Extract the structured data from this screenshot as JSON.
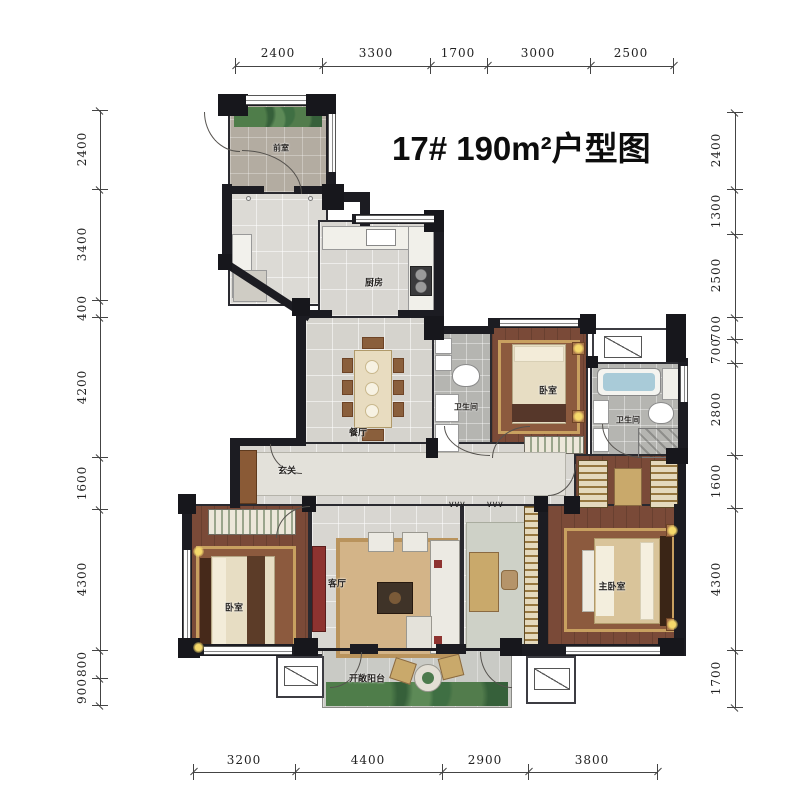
{
  "title": "17# 190m²户型图",
  "plan": {
    "rooms": {
      "vestibule": "前室",
      "kitchen": "厨房",
      "dining": "餐厅",
      "bath1": "卫生间",
      "bedroom2": "卧室",
      "bath2": "卫生间",
      "foyer": "玄关",
      "living": "客厅",
      "bedroom3": "卧室",
      "master_bedroom": "主卧室",
      "balcony": "开敞阳台"
    },
    "opening_marks": "∨∨∨"
  },
  "dimensions": {
    "top": [
      "2400",
      "3300",
      "1700",
      "3000",
      "2500"
    ],
    "bottom": [
      "3200",
      "4400",
      "2900",
      "3800"
    ],
    "left": [
      "2400",
      "3400",
      "400",
      "4200",
      "1600",
      "4300",
      "800",
      "900"
    ],
    "right": [
      "2400",
      "1300",
      "2500",
      "700",
      "700",
      "2800",
      "1600",
      "4300",
      "1700"
    ]
  },
  "palette": {
    "wall": "#1c1c22",
    "wood_floor": "#7a4a38",
    "marble_floor": "#d8d6d1",
    "bath_floor": "#b5b5b1",
    "rug_gold": "#c9a96b",
    "plant_green": "#4c7a4c",
    "tub_blue": "#a9cbd8",
    "tv_cabinet_red": "#8e3330"
  }
}
